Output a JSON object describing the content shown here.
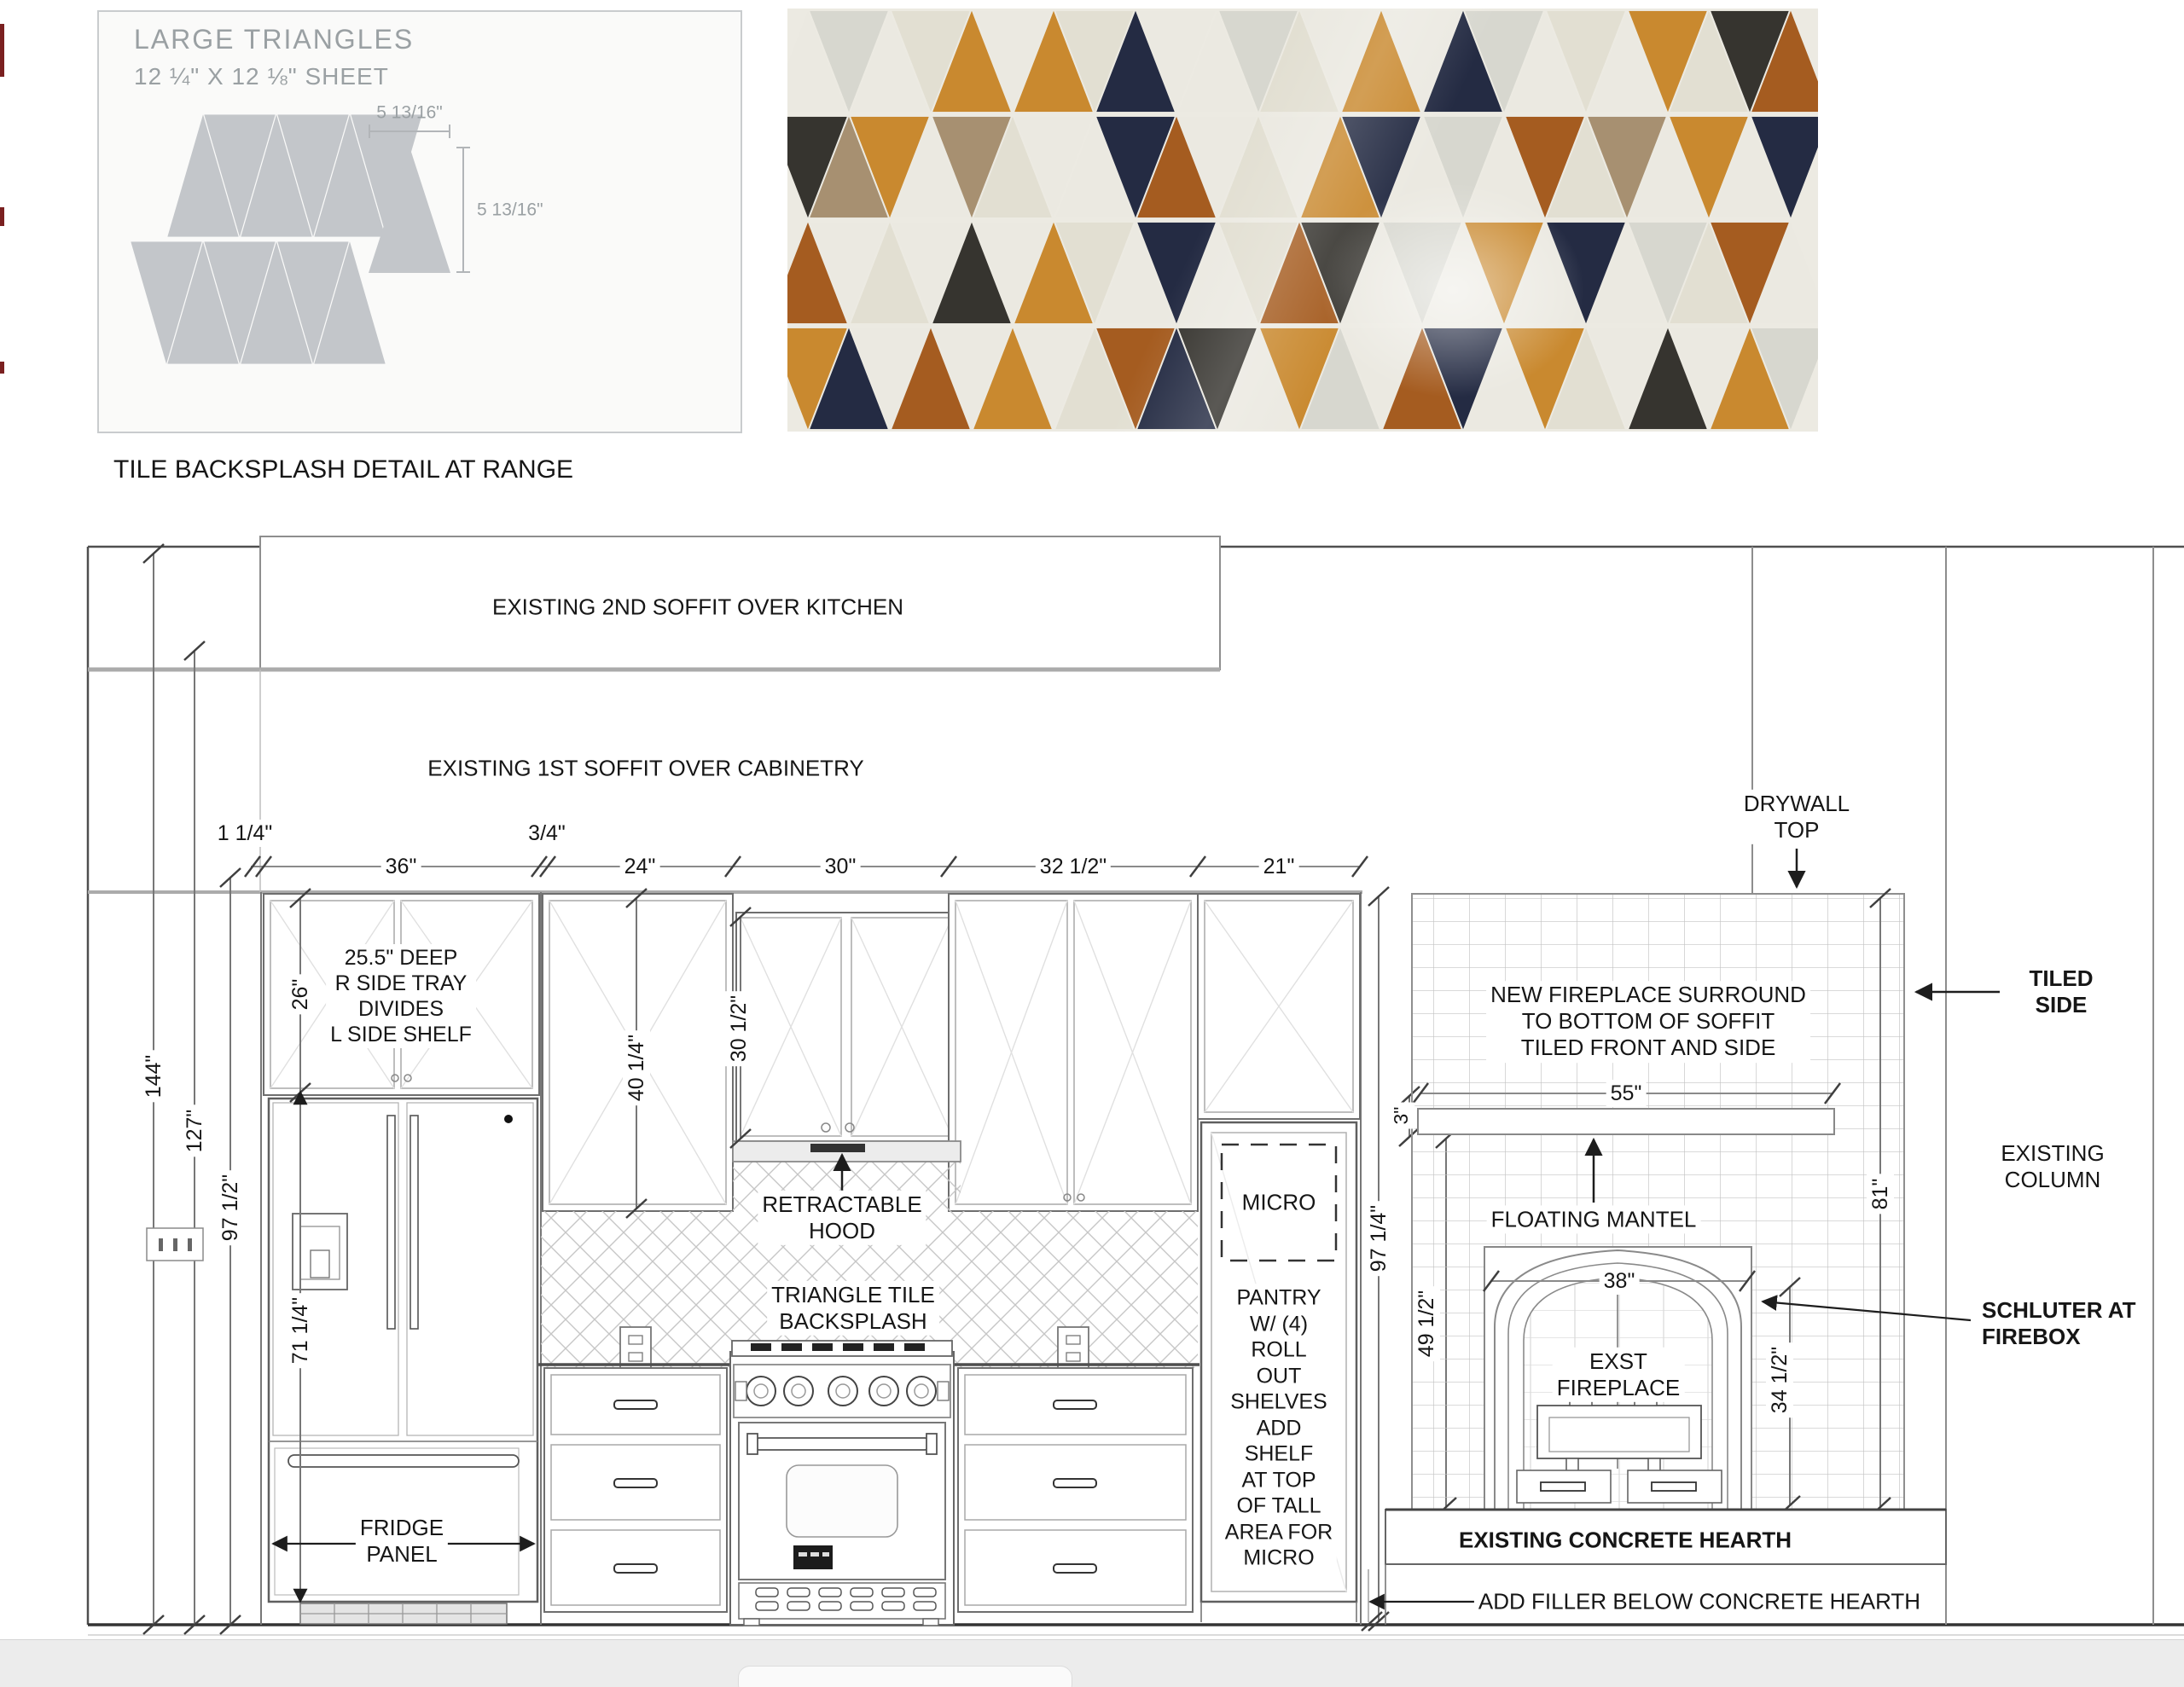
{
  "detail_box": {
    "title": "LARGE TRIANGLES",
    "subtitle": "12 ¼\" X 12 ⅛\" SHEET",
    "tri_width": "5 13/16\"",
    "tri_height": "5 13/16\"",
    "triangle_color": "#c3c6ca"
  },
  "caption": "TILE BACKSPLASH DETAIL AT RANGE",
  "tile_photo": {
    "palette": {
      "W": "#ebe9e1",
      "G": "#d7d7cf",
      "C": "#e2dfd2",
      "A": "#c9892f",
      "O": "#a55c20",
      "N": "#242b43",
      "K": "#36342f",
      "T": "#a79071"
    },
    "rows": [
      [
        "W",
        "G",
        "W",
        "C",
        "A",
        "W",
        "A",
        "C",
        "N",
        "W",
        "W",
        "G",
        "C",
        "W",
        "A",
        "W",
        "N",
        "G",
        "W",
        "C",
        "W",
        "A",
        "C",
        "K",
        "O"
      ],
      [
        "K",
        "T",
        "A",
        "W",
        "T",
        "C",
        "W",
        "W",
        "N",
        "O",
        "W",
        "C",
        "W",
        "A",
        "N",
        "W",
        "G",
        "W",
        "O",
        "C",
        "T",
        "W",
        "A",
        "W",
        "N"
      ],
      [
        "O",
        "W",
        "C",
        "W",
        "K",
        "W",
        "A",
        "C",
        "W",
        "N",
        "W",
        "C",
        "O",
        "K",
        "W",
        "G",
        "W",
        "A",
        "W",
        "N",
        "W",
        "G",
        "C",
        "O",
        "W"
      ],
      [
        "A",
        "N",
        "W",
        "O",
        "W",
        "A",
        "W",
        "C",
        "O",
        "N",
        "K",
        "W",
        "A",
        "G",
        "W",
        "O",
        "N",
        "W",
        "A",
        "C",
        "W",
        "K",
        "W",
        "A",
        "G"
      ]
    ]
  },
  "elevation": {
    "labels": {
      "s2": "EXISTING 2ND SOFFIT OVER KITCHEN",
      "s1": "EXISTING 1ST SOFFIT OVER CABINETRY",
      "d114": "1 1/4\"",
      "d34": "3/4\"",
      "d36": "36\"",
      "d24": "24\"",
      "d30": "30\"",
      "d325": "32 1/2\"",
      "d21": "21\"",
      "cab_note": "25.5\" DEEP\nR SIDE TRAY\nDIVIDES\nL SIDE SHELF",
      "d26": "26\"",
      "d4014": "40 1/4\"",
      "d3012": "30 1/2\"",
      "hood": "RETRACTABLE\nHOOD",
      "backsplash": "TRIANGLE TILE\nBACKSPLASH",
      "d144": "144\"",
      "d127": "127\"",
      "d975": "97 1/2\"",
      "d7114": "71 1/4\"",
      "fridge_panel": "FRIDGE\nPANEL",
      "micro": "MICRO",
      "pantry_note": "PANTRY\nW/ (4)\nROLL\nOUT\nSHELVES\nADD\nSHELF\nAT TOP\nOF TALL\nAREA FOR\nMICRO",
      "d9714": "97 1/4\"",
      "d3": "3\"",
      "surround": "NEW FIREPLACE SURROUND\nTO BOTTOM OF SOFFIT\nTILED FRONT AND SIDE",
      "d55": "55\"",
      "mantel": "FLOATING MANTEL",
      "d81": "81\"",
      "d4912": "49 1/2\"",
      "d38": "38\"",
      "exst": "EXST\nFIREPLACE",
      "d3412": "34 1/2\"",
      "drywall": "DRYWALL\nTOP",
      "tiled_side": "TILED SIDE",
      "column": "EXISTING\nCOLUMN",
      "schluter": "SCHLUTER AT\nFIREBOX",
      "hearth": "EXISTING CONCRETE HEARTH",
      "filler": "ADD FILLER BELOW CONCRETE HEARTH"
    }
  }
}
